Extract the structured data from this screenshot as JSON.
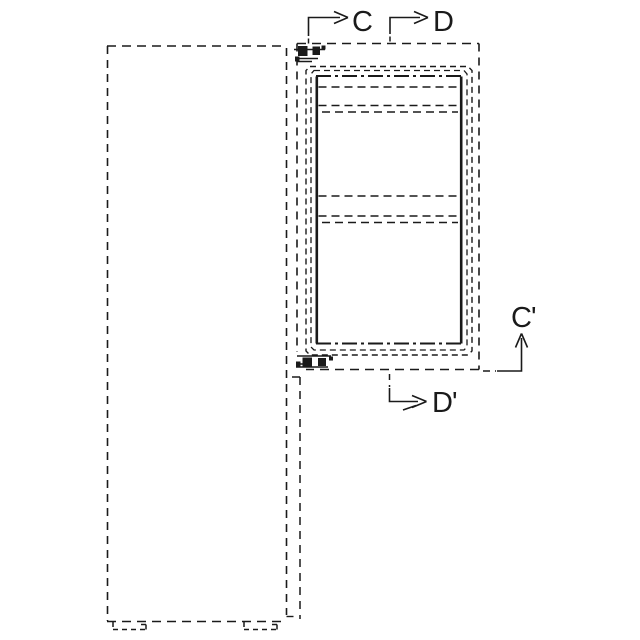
{
  "figure": {
    "type": "patent-line-drawing",
    "description": "Dashed-outline elevation of a cabinet body with an open door panel showing interior shelf lines, hinges, and cross-section markers",
    "background_color": "#ffffff",
    "line_color": "#1a1a1a",
    "section_markers": {
      "c": "C",
      "d": "D",
      "c_prime": "C'",
      "d_prime": "D'"
    }
  }
}
